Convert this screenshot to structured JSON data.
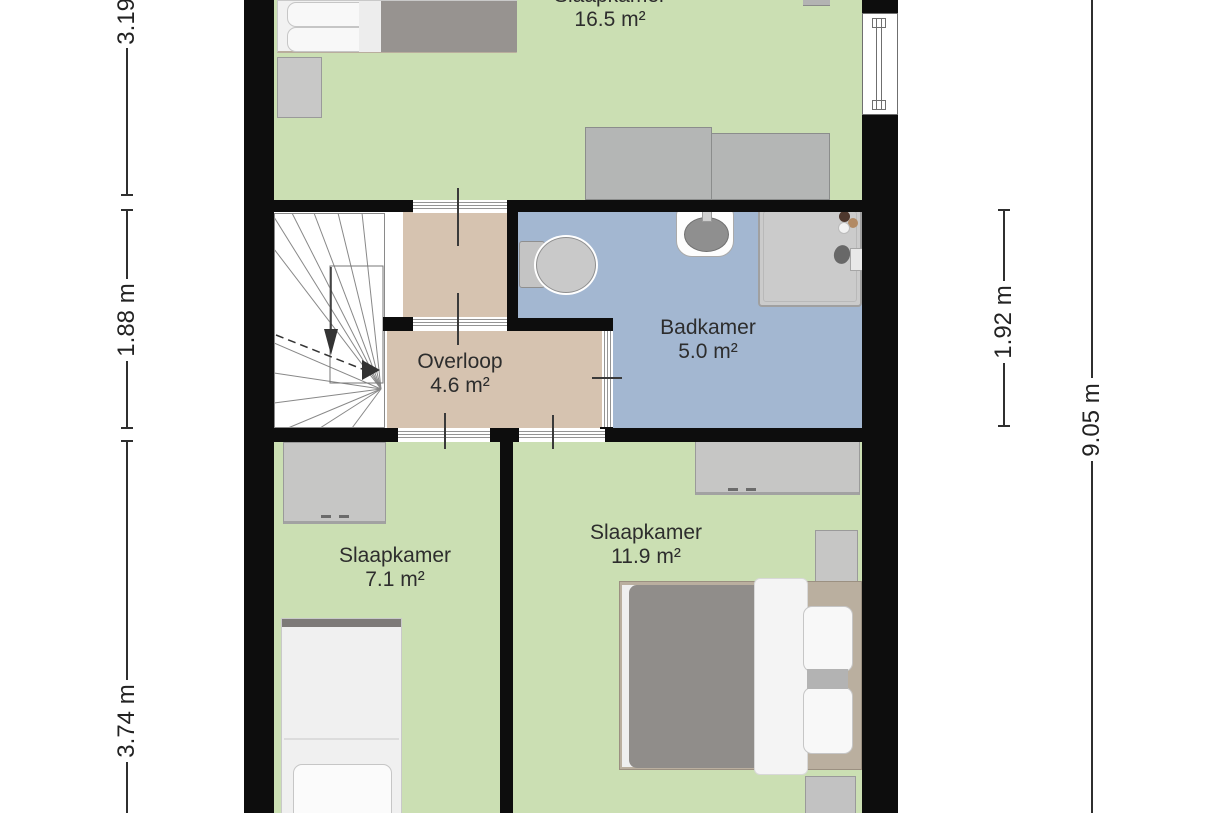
{
  "rooms": [
    {
      "name": "Slaapkamer",
      "area": "16.5 m²"
    },
    {
      "name": "Badkamer",
      "area": "5.0 m²"
    },
    {
      "name": "Overloop",
      "area": "4.6 m²"
    },
    {
      "name": "Slaapkamer",
      "area": "7.1 m²"
    },
    {
      "name": "Slaapkamer",
      "area": "11.9 m²"
    }
  ],
  "dimensions": {
    "left": [
      {
        "label": "3.19 m"
      },
      {
        "label": "1.88 m"
      },
      {
        "label": "3.74 m"
      }
    ],
    "right": [
      {
        "label": "1.92 m"
      },
      {
        "label": "9.05 m"
      }
    ]
  },
  "colors": {
    "floor_bedroom": "#cbdfb3",
    "floor_bathroom": "#a3b7d1",
    "floor_landing": "#d6c3b0",
    "wall": "#0d0d0d",
    "background": "#ffffff"
  },
  "furniture": [
    "double-bed",
    "single-bed",
    "bed",
    "wardrobe",
    "closet",
    "desk",
    "nightstand",
    "toilet",
    "sink",
    "shower",
    "dresser",
    "staircase",
    "window"
  ]
}
